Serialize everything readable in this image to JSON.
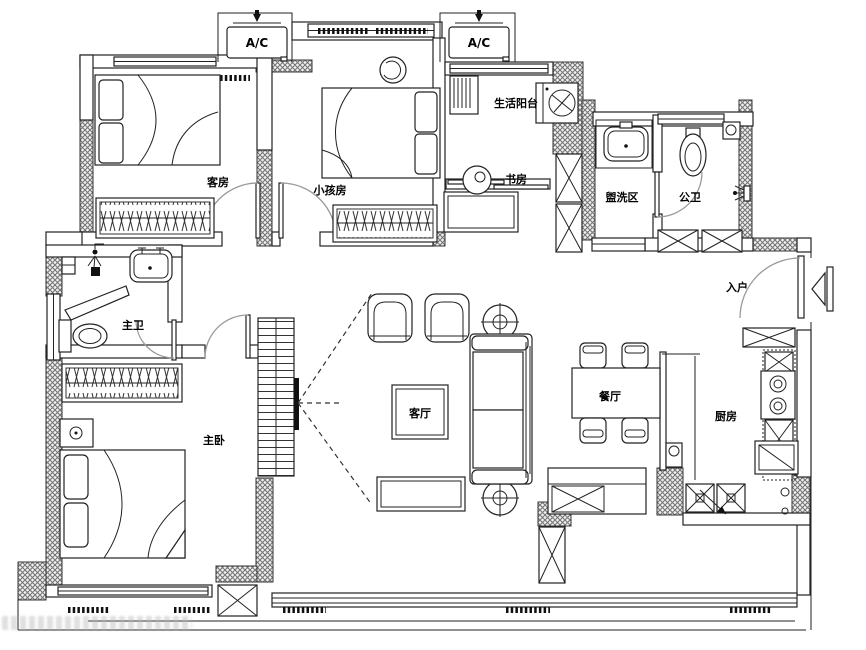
{
  "plan": {
    "rooms": [
      {
        "id": "guest-room",
        "label": "客房"
      },
      {
        "id": "kids-room",
        "label": "小孩房"
      },
      {
        "id": "laundry-balcony",
        "label": "生活阳台"
      },
      {
        "id": "study",
        "label": "书房"
      },
      {
        "id": "wash-area",
        "label": "盥洗区"
      },
      {
        "id": "public-bathroom",
        "label": "公卫"
      },
      {
        "id": "entry",
        "label": "入户"
      },
      {
        "id": "master-bathroom",
        "label": "主卫"
      },
      {
        "id": "master-bedroom",
        "label": "主卧"
      },
      {
        "id": "living-room",
        "label": "客厅"
      },
      {
        "id": "dining-room",
        "label": "餐厅"
      },
      {
        "id": "kitchen",
        "label": "厨房"
      }
    ],
    "ac_units": [
      {
        "label": "A/C"
      },
      {
        "label": "A/C"
      }
    ],
    "colors": {
      "background": "#ffffff",
      "line": "#1a1a1a",
      "wall_hatch": "#777777",
      "door_arc": "#9a9a9a",
      "label": "#000000"
    }
  }
}
